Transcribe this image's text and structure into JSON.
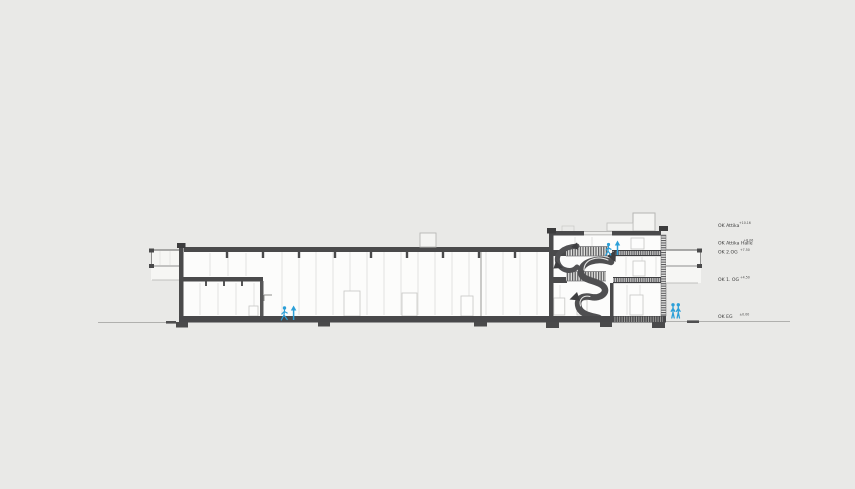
{
  "canvas": {
    "width": 855,
    "height": 489,
    "background": "#e9e9e7"
  },
  "drawing_type": "architectural-building-section",
  "levels": [
    {
      "label": "OK Attika",
      "value": "+10.16"
    },
    {
      "label": "OK Attika Halle",
      "value": "+8.06"
    },
    {
      "label": "OK 2.OG",
      "value": "+7.50"
    },
    {
      "label": "OK 1. OG",
      "value": "+4.50"
    },
    {
      "label": "OK EG",
      "value": "±0.00"
    }
  ],
  "colors": {
    "background": "#e9e9e7",
    "structure": "#4a4a4b",
    "structure_dark": "#3c3c3d",
    "line_medium": "#8f8f8e",
    "line_light": "#d2d2d0",
    "interior_fill": "#fcfcfb",
    "accent_blue": "#2b9fd8",
    "label_text": "#3a3a3a"
  },
  "figures": [
    {
      "icon": "walking-person-icon",
      "location": "hall-ground-floor"
    },
    {
      "icon": "up-arrow-icon",
      "location": "hall-ground-floor"
    },
    {
      "icon": "walking-person-icon",
      "location": "second-floor-landing"
    },
    {
      "icon": "up-arrow-icon",
      "location": "second-floor-landing"
    },
    {
      "icon": "standing-person-icon",
      "location": "outside-right-1"
    },
    {
      "icon": "standing-person-icon",
      "location": "outside-right-2"
    }
  ]
}
